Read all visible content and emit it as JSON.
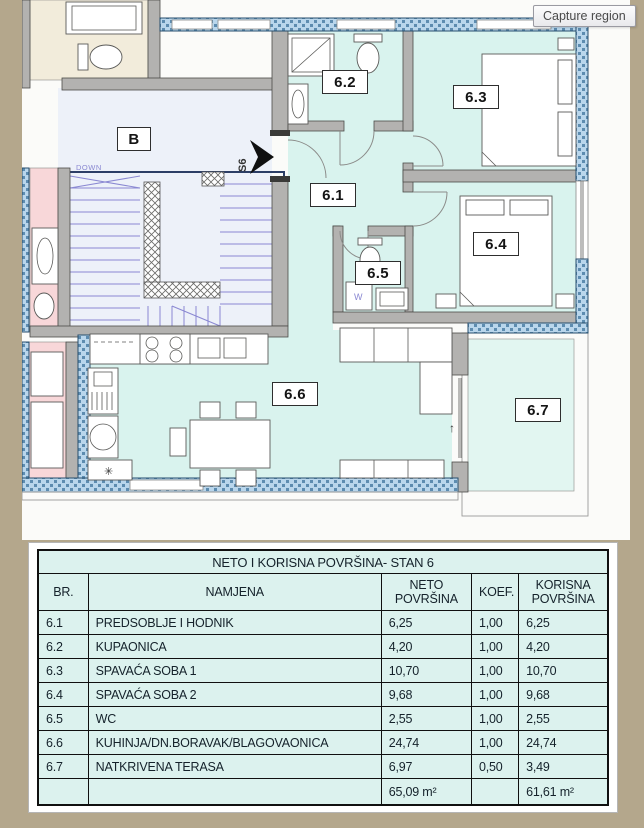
{
  "capture": {
    "label": "Capture region"
  },
  "plan": {
    "building_label": "B",
    "down_label": "DOWN",
    "entrance_marker": "S6",
    "washer_label": "W",
    "room_labels": {
      "r61": "6.1",
      "r62": "6.2",
      "r63": "6.3",
      "r64": "6.4",
      "r65": "6.5",
      "r66": "6.6",
      "r67": "6.7"
    },
    "icons": {
      "snowflake": "✳",
      "terrace_door_arrow": "↑"
    }
  },
  "table": {
    "title": "NETO I KORISNA POVRŠINA- STAN 6",
    "columns": [
      "BR.",
      "NAMJENA",
      "NETO POVRŠINA",
      "KOEF.",
      "KORISNA POVRŠINA"
    ],
    "rows": [
      [
        "6.1",
        "PREDSOBLJE I HODNIK",
        "6,25",
        "1,00",
        "6,25"
      ],
      [
        "6.2",
        "KUPAONICA",
        "4,20",
        "1,00",
        "4,20"
      ],
      [
        "6.3",
        "SPAVAĆA SOBA 1",
        "10,70",
        "1,00",
        "10,70"
      ],
      [
        "6.4",
        "SPAVAĆA SOBA 2",
        "9,68",
        "1,00",
        "9,68"
      ],
      [
        "6.5",
        "WC",
        "2,55",
        "1,00",
        "2,55"
      ],
      [
        "6.6",
        "KUHINJA/DN.BORAVAK/BLAGOVAONICA",
        "24,74",
        "1,00",
        "24,74"
      ],
      [
        "6.7",
        "NATKRIVENA TERASA",
        "6,97",
        "0,50",
        "3,49"
      ]
    ],
    "totals": {
      "neto": "65,09 m²",
      "korisna": "61,61 m²"
    }
  },
  "colors": {
    "bg_tan": "#b4a78c",
    "plan_bg": "#fbfbf9",
    "floor_cyan": "#d9f3ee",
    "floor_light": "#edf1f9",
    "wall_gray": "#b3b2b0",
    "hatch_blue": "#b9d6ec",
    "hatch_border": "#274e6d",
    "stair_purple": "#8a88d2",
    "room_pink": "#f8d7d9",
    "room_cream": "#f2ecdb",
    "cell_bg": "#dcf2ee",
    "ink": "#15222b"
  }
}
